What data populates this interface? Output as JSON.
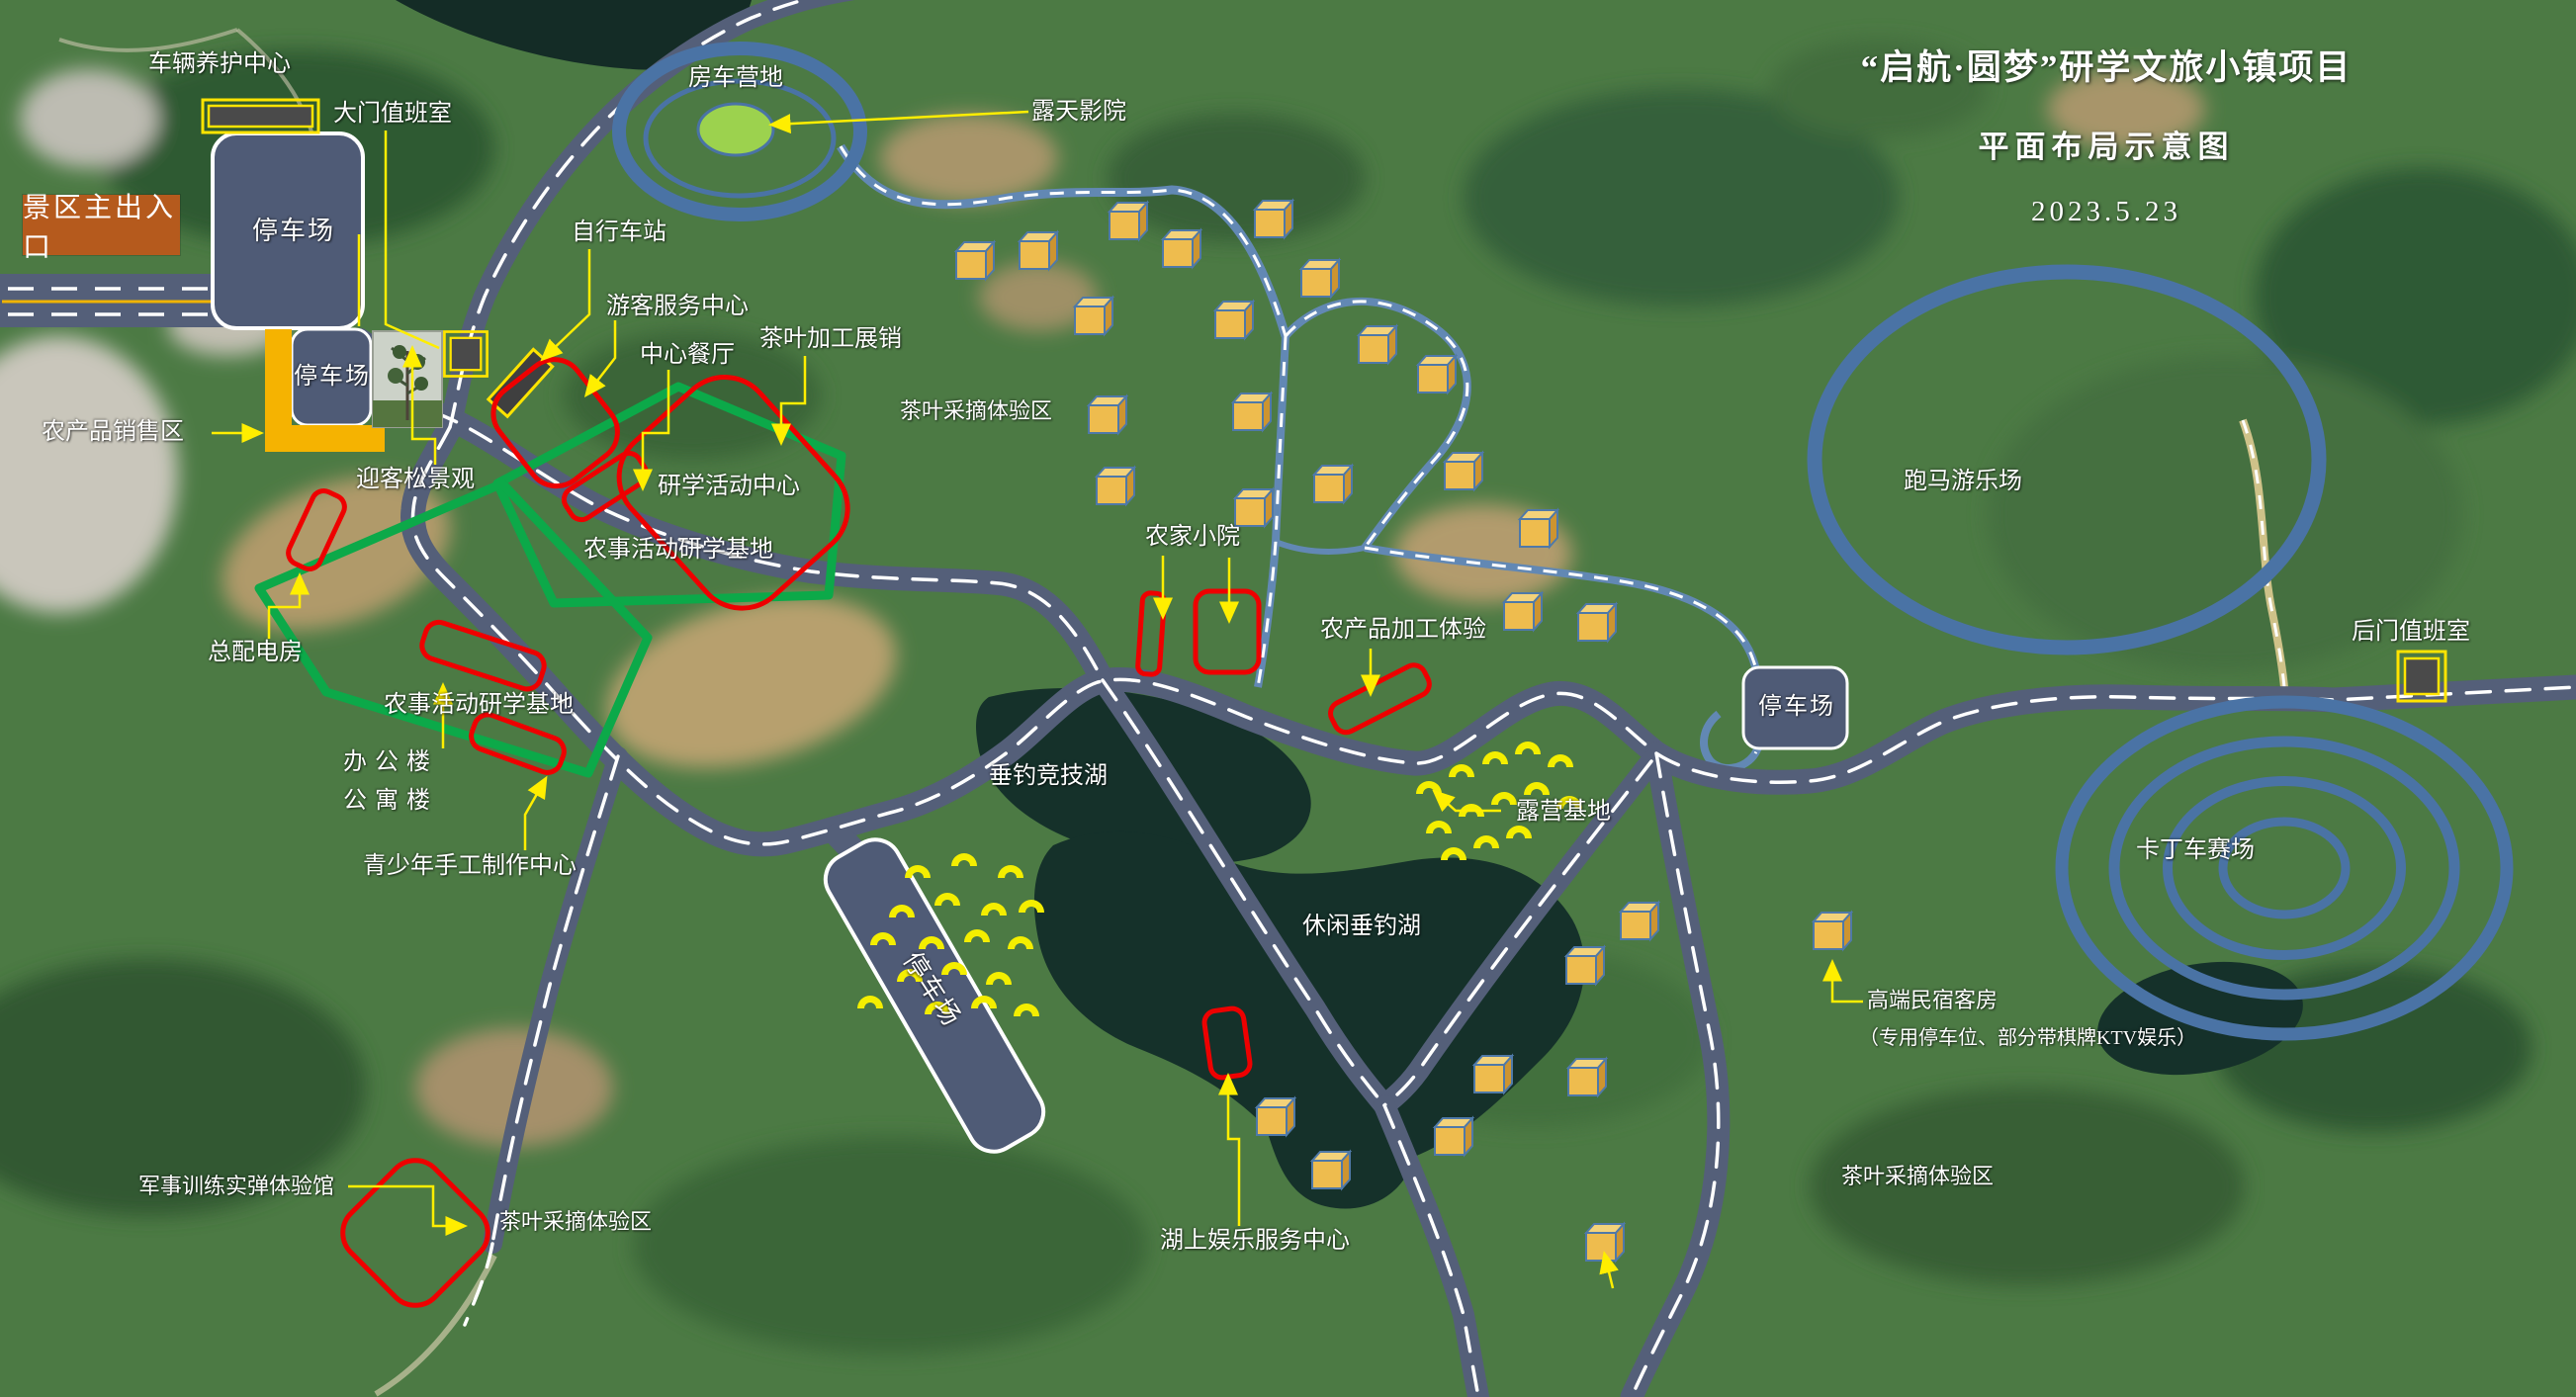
{
  "title": {
    "line1": "“启航·圆梦”研学文旅小镇项目",
    "line2": "平面布局示意图",
    "date": "2023.5.23"
  },
  "entrance": {
    "main_gate": "景区主出入口"
  },
  "facilities": {
    "vehicle_center": "车辆养护中心",
    "gate_office": "大门值班室",
    "rv_camp": "房车营地",
    "open_air_cinema": "露天影院",
    "bike_station": "自行车站",
    "visitor_center": "游客服务中心",
    "central_restaurant": "中心餐厅",
    "tea_processing": "茶叶加工展销",
    "study_center": "研学活动中心",
    "agri_sales": "农产品销售区",
    "welcome_pine": "迎客松景观",
    "power_room": "总配电房",
    "office_building": "办公楼",
    "apartment_building": "公寓楼",
    "youth_craft_center": "青少年手工制作中心",
    "farm_base": "农事活动研学基地",
    "farm_house": "农家小院",
    "agri_processing": "农产品加工体验",
    "camping_base": "露营基地",
    "fishing_lake_sport": "垂钓竞技湖",
    "fishing_lake_leisure": "休闲垂钓湖",
    "parking": "停车场",
    "horse_ground": "跑马游乐场",
    "kart_track": "卡丁车赛场",
    "back_gate_office": "后门值班室",
    "bnb_line1": "高端民宿客房",
    "bnb_line2": "（专用停车位、部分带棋牌KTV娱乐）",
    "military_hall": "军事训练实弹体验馆",
    "lake_service": "湖上娱乐服务中心",
    "tea_picking": "茶叶采摘体验区"
  },
  "icons": {
    "cabin": "cabin-cube-icon",
    "tent": "tent-icon",
    "gate_box": "gate-office-icon",
    "bike_stand": "bike-station-icon",
    "pine_photo": "welcome-pine-photo"
  },
  "colors": {
    "road": "#545f79",
    "trail_blue": "#6288b4",
    "ring_blue": "#4a73a5",
    "highlight_red": "#ee0000",
    "zone_green": "#0ca949",
    "leader_yellow": "#ffee00",
    "cabin_gold": "#eebc4e",
    "tent_yellow": "#f4ee00",
    "entrance_orange": "#b55a1d",
    "sales_yellow": "#f5b301",
    "rv_green": "#9cd24e"
  }
}
